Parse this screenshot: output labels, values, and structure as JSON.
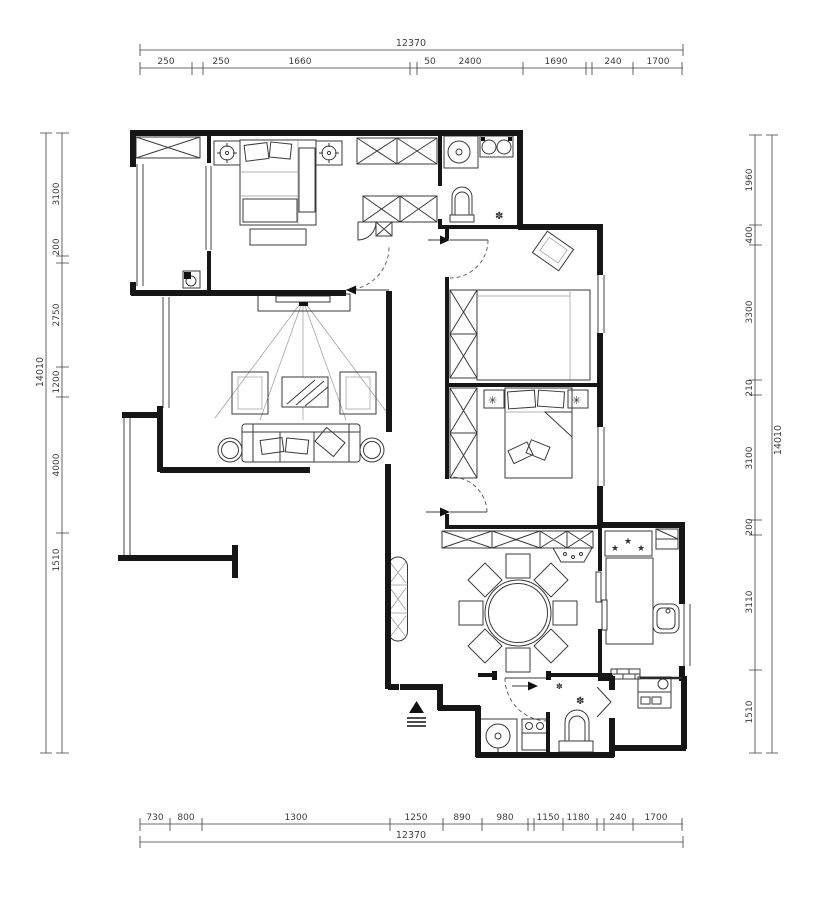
{
  "drawing": {
    "type": "floor-plan",
    "colors": {
      "wall": "#161616",
      "furniture": "#3a3a3a",
      "dimension": "#3d3d3d",
      "background": "#ffffff"
    },
    "dimensions": {
      "top": {
        "total": "12370",
        "segments": [
          "250",
          "250",
          "1660",
          "50",
          "2400",
          "1690",
          "240",
          "1700"
        ]
      },
      "bottom": {
        "total": "12370",
        "segments": [
          "730",
          "800",
          "1300",
          "1250",
          "890",
          "980",
          "1150",
          "1180",
          "240",
          "1700"
        ]
      },
      "left": {
        "total": "14010",
        "segments": [
          "3100",
          "200",
          "2750",
          "1200",
          "4000",
          "1510"
        ]
      },
      "right": {
        "total": "14010",
        "segments": [
          "1960",
          "400",
          "3300",
          "210",
          "3100",
          "200",
          "3110",
          "1510"
        ]
      }
    },
    "symbols": {
      "floor_drain": "✽",
      "burner": "★",
      "table_lamp": "✳"
    }
  }
}
